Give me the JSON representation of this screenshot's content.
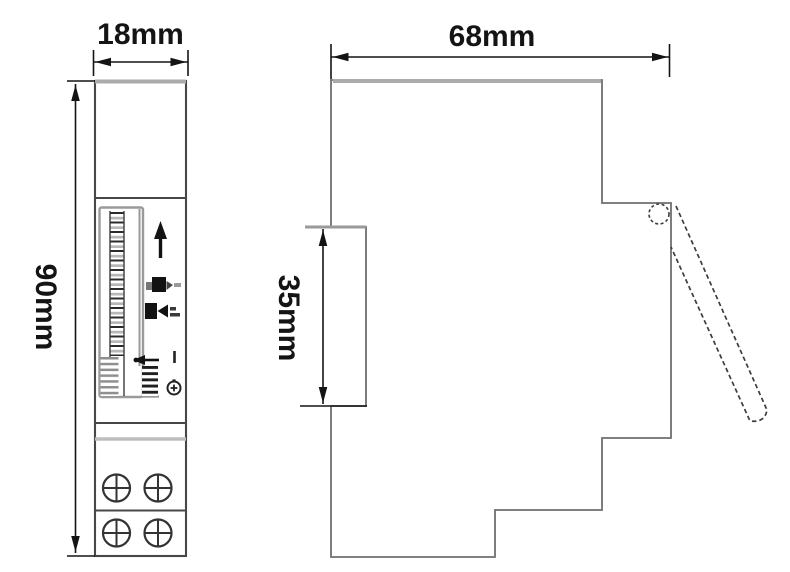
{
  "dims": {
    "front_width": "18mm",
    "front_height": "90mm",
    "side_depth": "68mm",
    "din_recess_height": "35mm"
  },
  "icons": {
    "rotation_arrow": "up-arrow ↑",
    "dial_pointer": "left-arrow ←",
    "on_marker": "I",
    "clock": "clock-dial ⊕",
    "mode_switch": "black square glyphs ▮◄",
    "screw_terminal": "cross-slot screw ⊕",
    "hinge": "dashed circle ○",
    "cover_open": "dashed flap"
  },
  "colors": {
    "background": "#ffffff",
    "outline_gray": "#6f6f6f",
    "edge_dark": "#474747",
    "edge_light": "#ababab",
    "frame_gray": "#9a9a9a",
    "dimension_ink": "#141414",
    "hatch_gray": "#8f8f8f",
    "hatch_dark": "#1f1f1f",
    "hatch_mid": "#b7b7b7"
  }
}
